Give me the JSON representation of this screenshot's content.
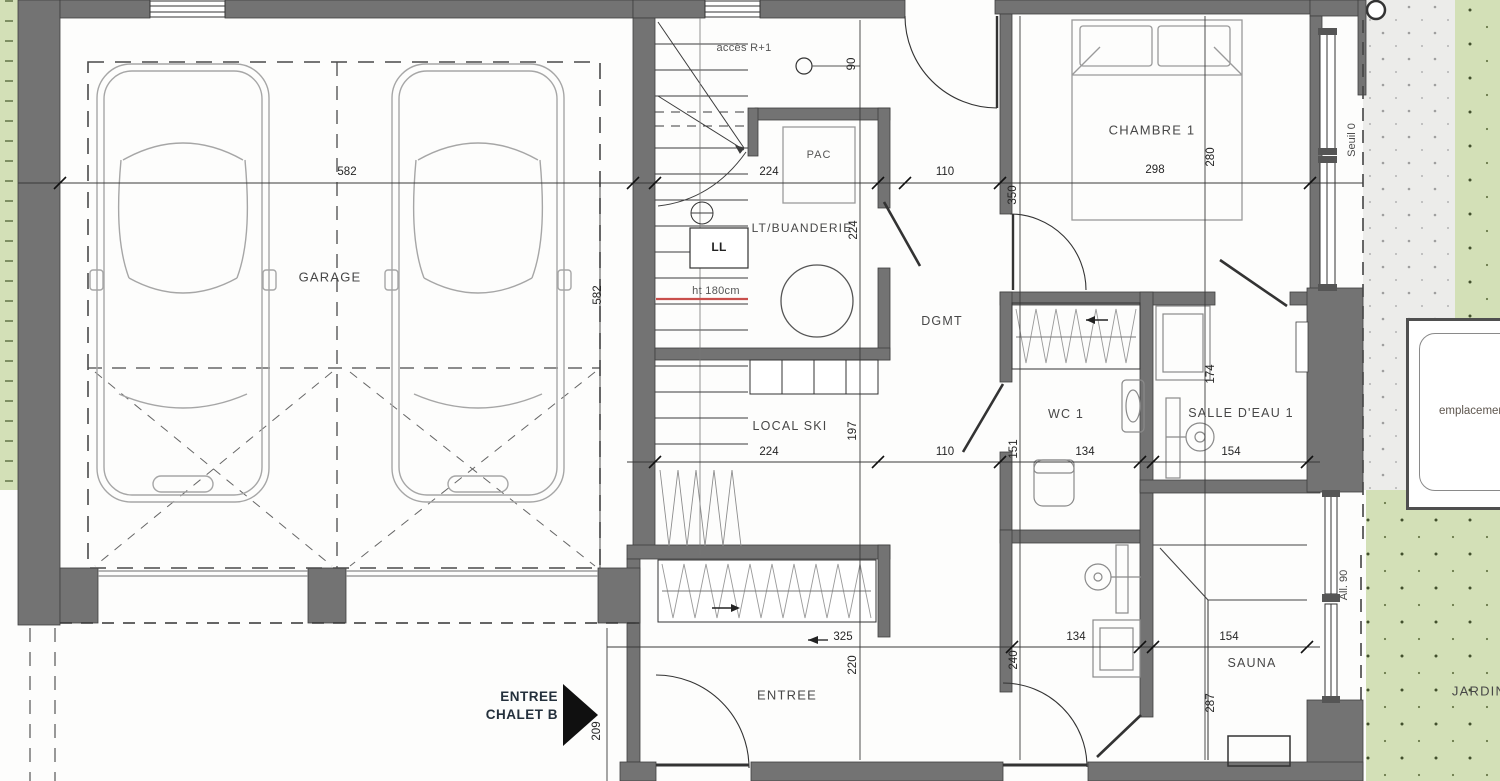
{
  "colors": {
    "wall": "#737373",
    "garden": "#d3e0b7",
    "terrace": "#ececea",
    "dimension_red": "#c94f4c"
  },
  "rooms": {
    "garage": "GARAGE",
    "chambre1": "CHAMBRE 1",
    "buanderie": "LT/BUANDERIE",
    "local_ski": "LOCAL SKI",
    "dgmt": "DGMT",
    "wc1": "WC 1",
    "salle_eau1": "SALLE D'EAU 1",
    "sauna": "SAUNA",
    "entree": "ENTREE",
    "jardin": "JARDIN"
  },
  "annotations": {
    "acces_etage": "accès R+1",
    "pac": "PAC",
    "lave_linge": "LL",
    "hauteur": "ht 180cm",
    "entree_chalet_line1": "ENTREE",
    "entree_chalet_line2": "CHALET B",
    "seuil": "Seuil 0",
    "allege": "All. 90",
    "emplacement": "emplacement possible o"
  },
  "dims": [
    "582",
    "224",
    "110",
    "298",
    "90",
    "582",
    "350",
    "280",
    "224",
    "174",
    "197",
    "224",
    "110",
    "151",
    "134",
    "154",
    "325",
    "134",
    "154",
    "220",
    "240",
    "287",
    "209"
  ]
}
